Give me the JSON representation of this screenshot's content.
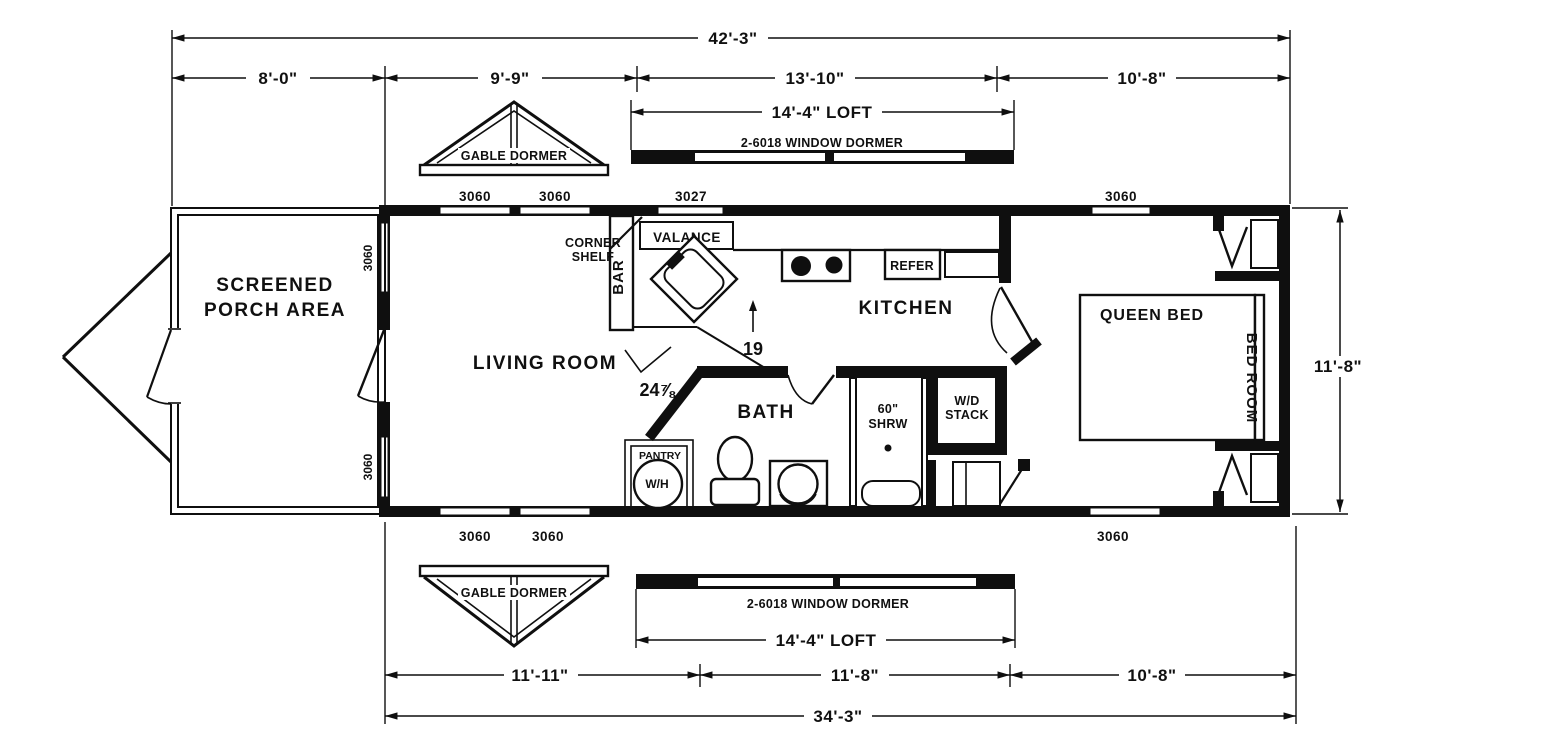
{
  "dims": {
    "overall_top": "42'-3\"",
    "porch_w": "8'-0\"",
    "living_w": "9'-9\"",
    "kitchen_w": "13'-10\"",
    "bedroom_w": "10'-8\"",
    "loft_top": "14'-4\" LOFT",
    "loft_bottom": "14'-4\" LOFT",
    "side_h": "11'-8\"",
    "living_w_b": "11'-11\"",
    "kitchen_w_b": "11'-8\"",
    "bedroom_w_b": "10'-8\"",
    "overall_bottom": "34'-3\"",
    "counter_19": "19",
    "counter_24": "24⅞"
  },
  "dormers": {
    "gable_top": "GABLE DORMER",
    "gable_bottom": "GABLE DORMER",
    "window_top": "2-6018 WINDOW DORMER",
    "window_bottom": "2-6018 WINDOW DORMER"
  },
  "rooms": {
    "porch_line1": "SCREENED",
    "porch_line2": "PORCH AREA",
    "living": "LIVING ROOM",
    "kitchen": "KITCHEN",
    "bath": "BATH"
  },
  "fixtures": {
    "corner_shelf_line1": "CORNER",
    "corner_shelf_line2": "SHELF",
    "valance": "VALANCE",
    "bar": "BAR",
    "refer": "REFER",
    "shower_line1": "60\"",
    "shower_line2": "SHRW",
    "wd_line1": "W/D",
    "wd_line2": "STACK",
    "pantry": "PANTRY",
    "water_heater": "W/H",
    "queen_bed": "QUEEN BED",
    "bed_room": "BED ROOM"
  },
  "windows": {
    "top": [
      "3060",
      "3060",
      "3027",
      "3060"
    ],
    "bottom": [
      "3060",
      "3060",
      "3060"
    ],
    "left": [
      "3060",
      "3060"
    ]
  }
}
